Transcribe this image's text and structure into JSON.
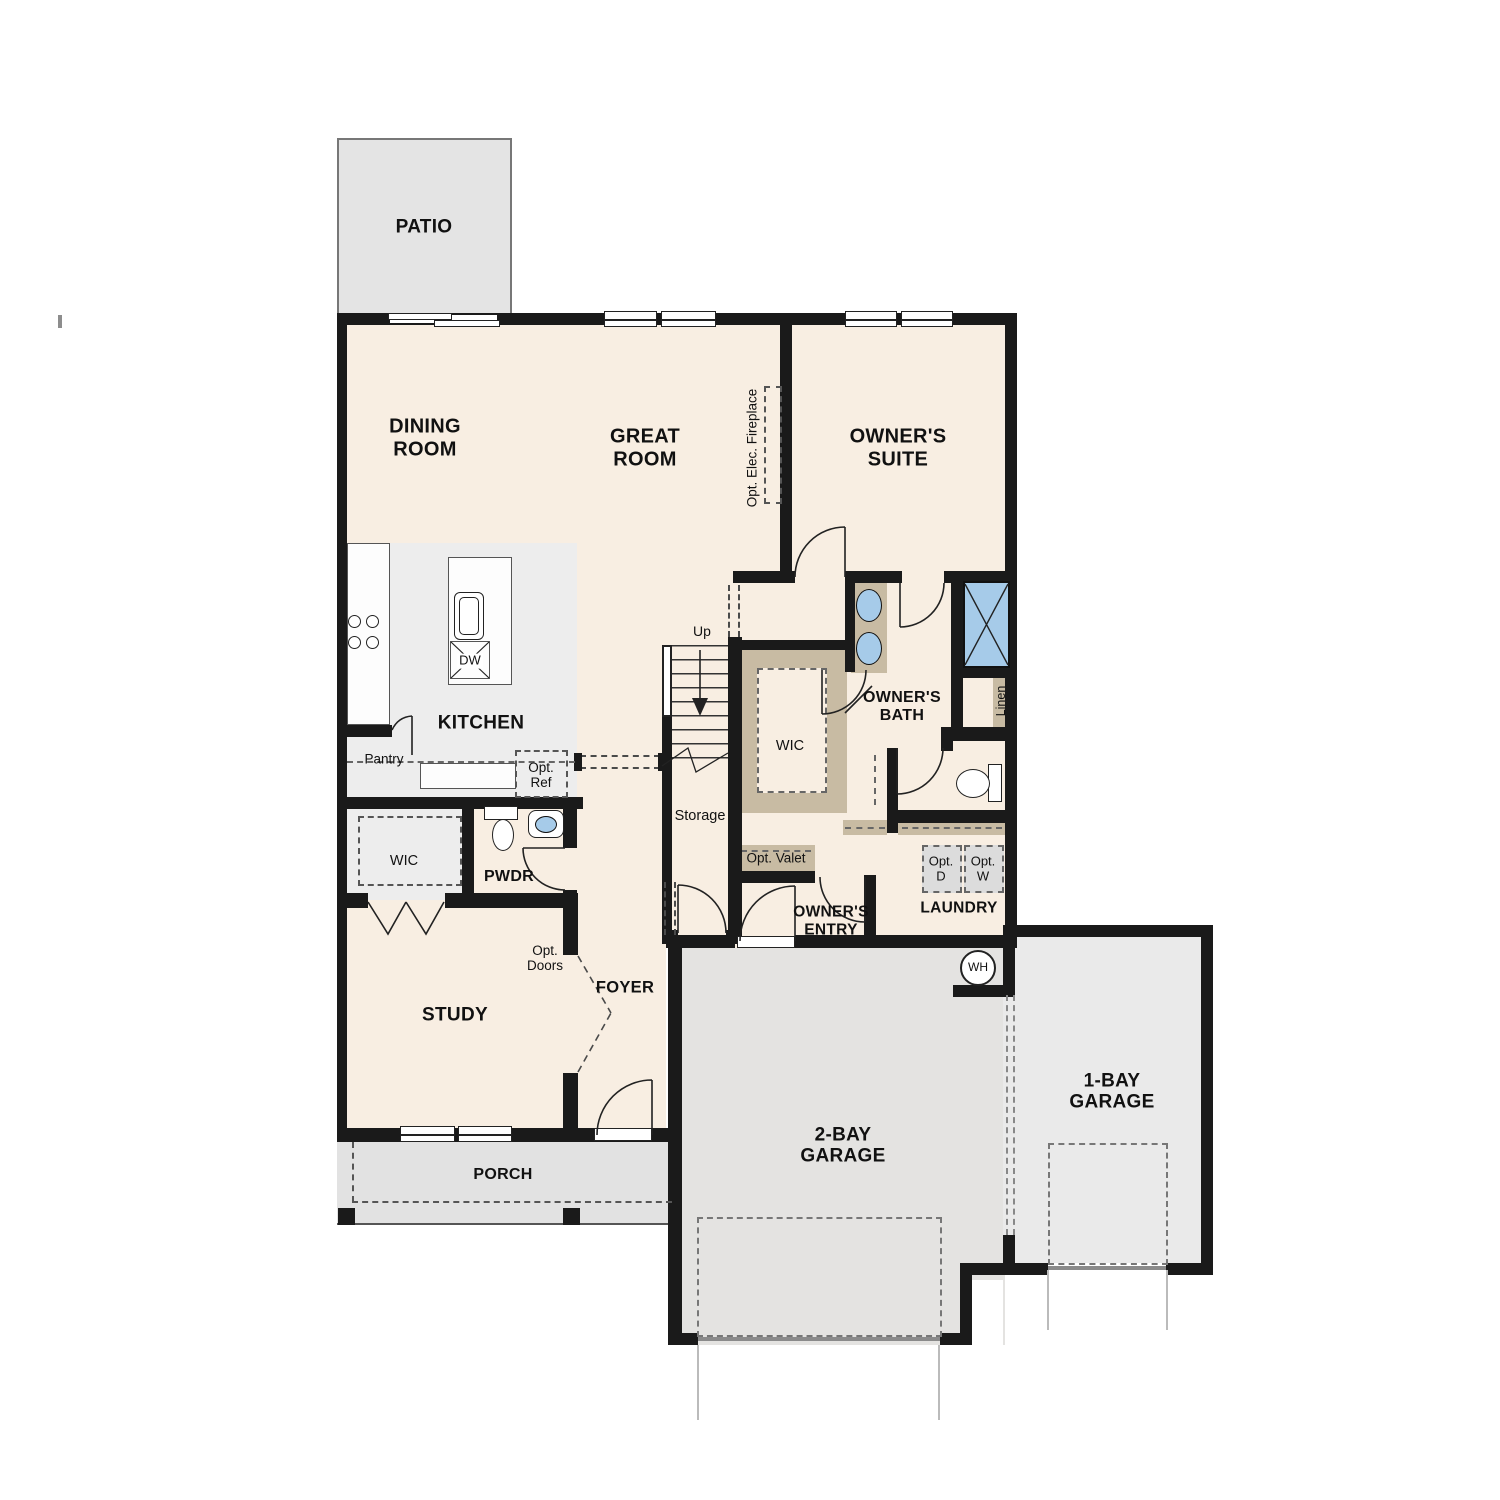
{
  "colors": {
    "wall": "#1a1a1a",
    "floor": "#f8eee2",
    "patio_gray": "#e4e4e4",
    "kitchen_gray": "#ededed",
    "porch_gray": "#e2e2e2",
    "garage2_gray": "#e4e3e1",
    "garage1_gray": "#eaeaea",
    "tan": "#c8bba3",
    "fixture_blue": "#a6cbe9"
  },
  "rooms": {
    "patio": "PATIO",
    "dining": "DINING\nROOM",
    "great": "GREAT\nROOM",
    "owners_suite": "OWNER'S\nSUITE",
    "kitchen": "KITCHEN",
    "owners_bath": "OWNER'S\nBATH",
    "wic_center": "WIC",
    "wic_left": "WIC",
    "pwdr": "PWDR",
    "study": "STUDY",
    "foyer": "FOYER",
    "owners_entry": "OWNER'S\nENTRY",
    "laundry": "LAUNDRY",
    "storage": "Storage",
    "porch": "PORCH",
    "garage_2bay": "2-BAY\nGARAGE",
    "garage_1bay": "1-BAY\nGARAGE"
  },
  "annotations": {
    "fireplace": "Opt. Elec. Fireplace",
    "pantry": "Pantry",
    "opt_ref": "Opt.\nRef",
    "dishwasher": "DW",
    "stairs_up": "Up",
    "linen": "Linen",
    "opt_valet": "Opt. Valet",
    "opt_dryer": "Opt.\nD",
    "opt_washer": "Opt.\nW",
    "water_heater": "WH",
    "opt_doors": "Opt.\nDoors"
  }
}
